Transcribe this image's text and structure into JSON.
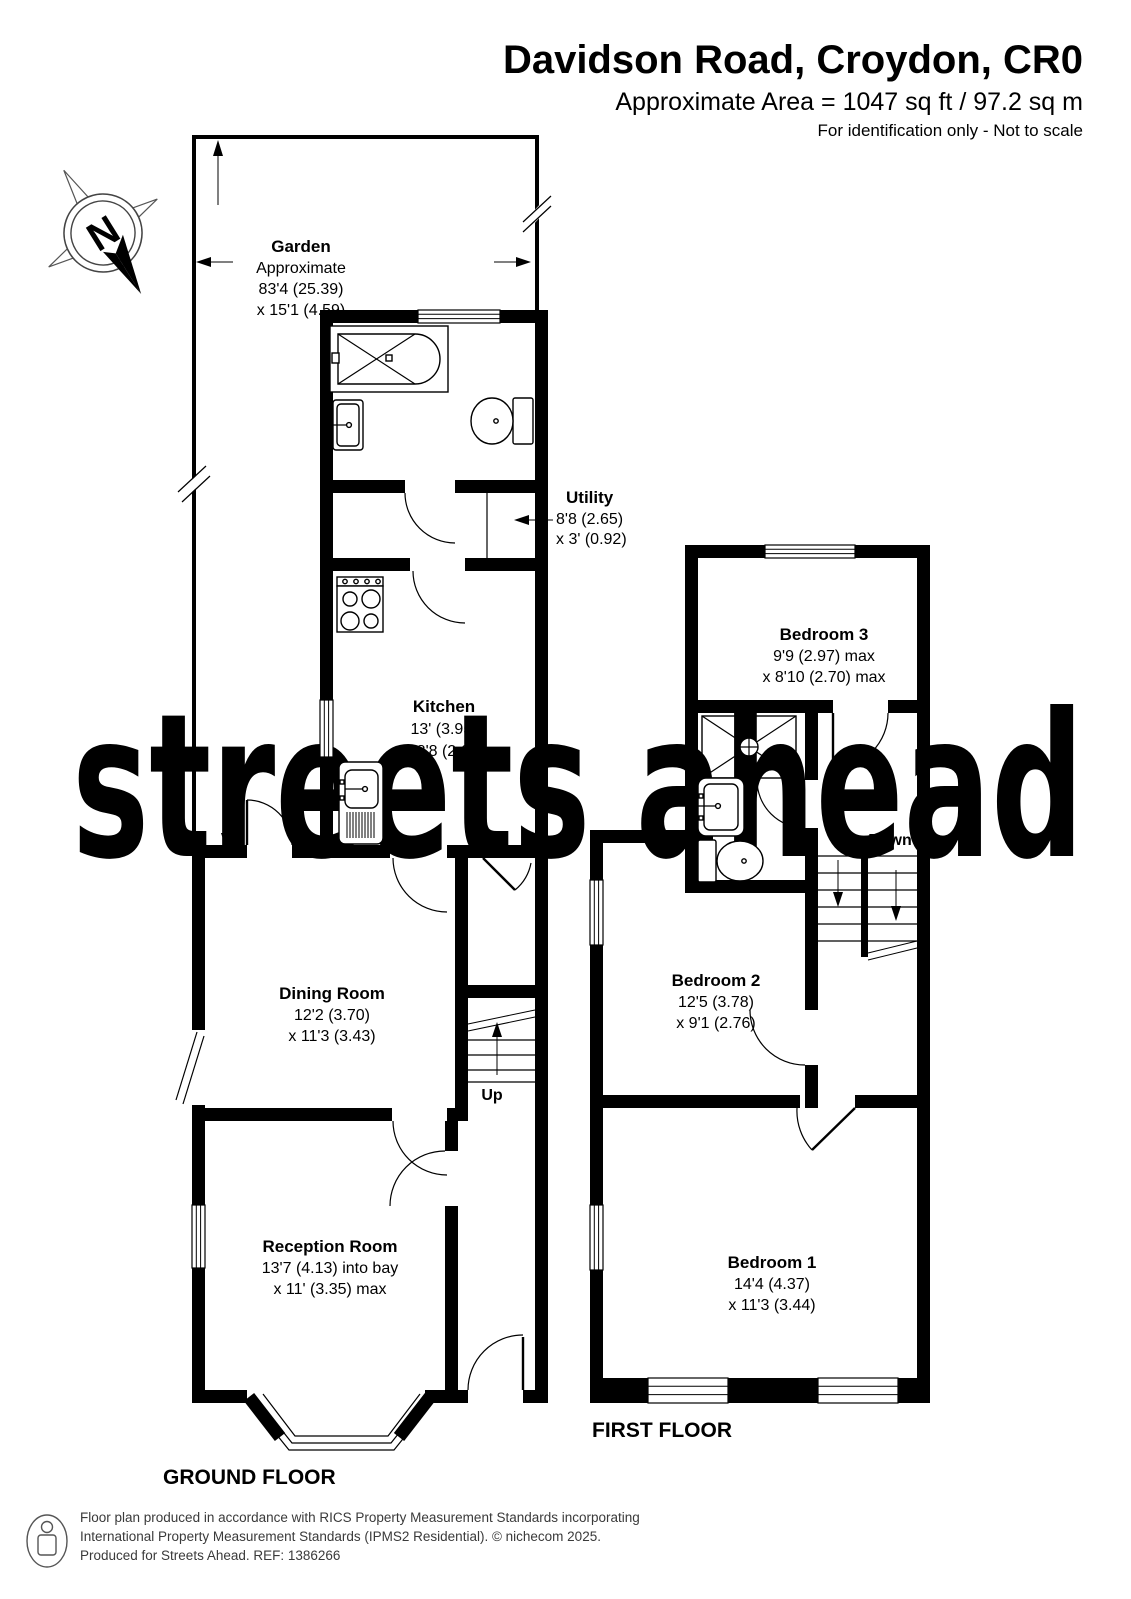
{
  "header": {
    "title": "Davidson Road, Croydon, CR0",
    "area_line": "Approximate Area = 1047 sq ft / 97.2 sq m",
    "note": "For identification only - Not to scale"
  },
  "compass": {
    "north_label": "N"
  },
  "watermark": {
    "text": "streets ahead",
    "color": "#deebc7"
  },
  "ground_floor": {
    "title": "GROUND FLOOR",
    "garden": {
      "name": "Garden",
      "line1": "Approximate",
      "line2": "83'4 (25.39)",
      "line3": "x 15'1 (4.59)"
    },
    "utility": {
      "name": "Utility",
      "dim1": "8'8 (2.65)",
      "dim2": "x 3' (0.92)"
    },
    "kitchen": {
      "name": "Kitchen",
      "dim1": "13' (3.95)",
      "dim2": "x 8'8 (2.65)"
    },
    "dining_room": {
      "name": "Dining Room",
      "dim1": "12'2 (3.70)",
      "dim2": "x 11'3 (3.43)"
    },
    "reception_room": {
      "name": "Reception Room",
      "dim1": "13'7 (4.13) into bay",
      "dim2": "x 11' (3.35) max"
    },
    "stairs_label": "Up"
  },
  "first_floor": {
    "title": "FIRST FLOOR",
    "bedroom3": {
      "name": "Bedroom 3",
      "dim1": "9'9 (2.97) max",
      "dim2": "x 8'10 (2.70) max"
    },
    "bedroom2": {
      "name": "Bedroom 2",
      "dim1": "12'5 (3.78)",
      "dim2": "x 9'1 (2.76)"
    },
    "bedroom1": {
      "name": "Bedroom 1",
      "dim1": "14'4 (4.37)",
      "dim2": "x 11'3 (3.44)"
    },
    "stairs_label": "Down"
  },
  "footer": {
    "line1": "Floor plan produced in accordance with RICS Property Measurement Standards incorporating",
    "line2": "International Property Measurement Standards (IPMS2 Residential).   © nichecom 2025.",
    "line3": "Produced for Streets Ahead.   REF:  1386266"
  }
}
